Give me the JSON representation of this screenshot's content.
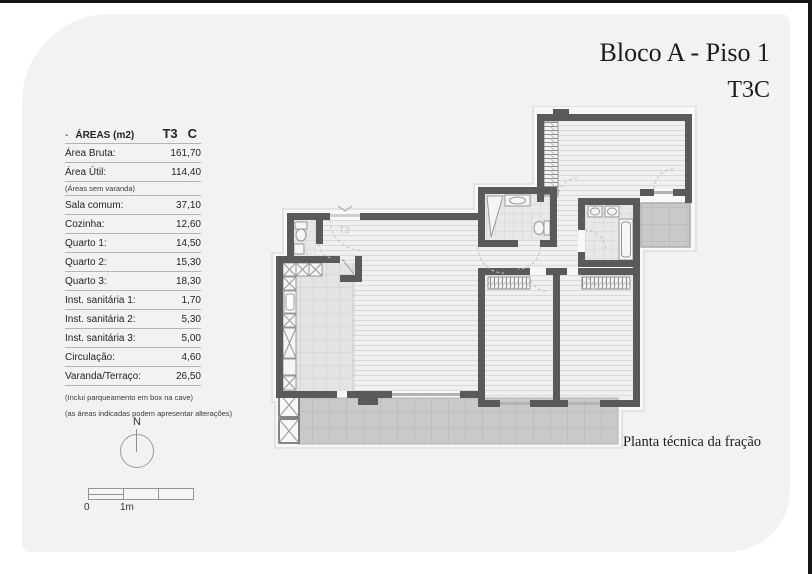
{
  "window": {
    "title_line1": "Bloco A - Piso 1",
    "title_line2": "T3C",
    "caption": "Planta técnica da fração"
  },
  "areas_table": {
    "header_dash": "-",
    "header_label": "ÁREAS (m2)",
    "header_type": "T3",
    "header_col": "C",
    "rows": [
      {
        "label": "Área Bruta:",
        "value": "161,70"
      },
      {
        "label": "Área Útil:",
        "value": "114,40"
      },
      {
        "label": "Sala comum:",
        "value": "37,10"
      },
      {
        "label": "Cozinha:",
        "value": "12,60"
      },
      {
        "label": "Quarto 1:",
        "value": "14,50"
      },
      {
        "label": "Quarto 2:",
        "value": "15,30"
      },
      {
        "label": "Quarto 3:",
        "value": "18,30"
      },
      {
        "label": "Inst. sanitária 1:",
        "value": "1,70"
      },
      {
        "label": "Inst. sanitária 2:",
        "value": "5,30"
      },
      {
        "label": "Inst. sanitária 3:",
        "value": "5,00"
      },
      {
        "label": "Circulação:",
        "value": "4,60"
      },
      {
        "label": "Varanda/Terraço:",
        "value": "26,50"
      }
    ],
    "note": "(Áreas sem varanda)",
    "footnote1": "(Inclui parqueamento em box na cave)",
    "footnote2": "(as áreas indicadas podem apresentar alterações)"
  },
  "compass": {
    "label": "N"
  },
  "scale_bar": {
    "label_zero": "0",
    "label_one": "1m"
  },
  "floorplan": {
    "entrance_label": "T3"
  },
  "colors": {
    "page_background": "#f2f2f2",
    "wall": "#5a5a5a",
    "terrace_tile": "#c9c9c9",
    "edge_bar": "#161616"
  }
}
